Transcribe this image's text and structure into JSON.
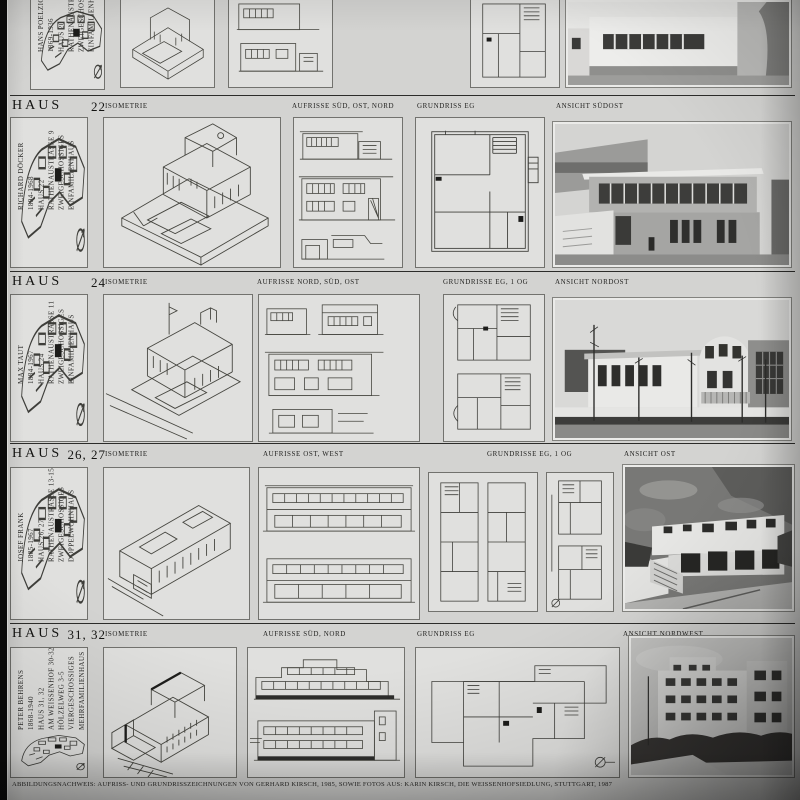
{
  "document": {
    "caption": "ABBILDUNGSNACHWEIS: AUFRISS- UND GRUNDRISSZEICHNUNGEN VON GERHARD KIRSCH, 1985, SOWIE FOTOS AUS: KARIN KIRSCH, DIE WEISSENHOFSIEDLUNG, STUTTGART, 1987",
    "top_partial_row": {
      "info": [
        "HANS POELZIG",
        "1869-1936",
        "HAUS 20",
        "RATHENAUSTRA",
        "ZWEIGESCHOSS",
        "EINFAMILIENHA"
      ],
      "zerstort": "ZERSTÖRT"
    },
    "rows": [
      {
        "header": {
          "haus": "HAUS",
          "number": "22",
          "cols": {
            "iso": "ISOMETRIE",
            "aufriss": "AUFRISSE SÜD, OST, NORD",
            "grundriss": "GRUNDRISS EG",
            "ansicht": "ANSICHT SÜDOST"
          }
        },
        "info": [
          "RICHARD DÖCKER",
          "1894-1968",
          "HAUS 22",
          "RATHENAUSTRASSE 9",
          "ZWEIGESCHOSSIGES",
          "EINFAMILIENHAUS"
        ],
        "zerstort": "ZERSTÖRT"
      },
      {
        "header": {
          "haus": "HAUS",
          "number": "24",
          "cols": {
            "iso": "ISOMETRIE",
            "aufriss": "AUFRISSE NORD, SÜD, OST",
            "grundriss": "GRUNDRISSE EG, 1 OG",
            "ansicht": "ANSICHT NORDOST"
          }
        },
        "info": [
          "MAX TAUT",
          "1884-1967",
          "HAUS 24",
          "RATHENAUSTRASSE 11",
          "ZWEIGESCHOSSIGES",
          "EINFAMILIENHAUS"
        ],
        "zerstort": "ZERSTÖRT"
      },
      {
        "header": {
          "haus": "HAUS",
          "number": "26, 27",
          "cols": {
            "iso": "ISOMETRIE",
            "aufriss": "AUFRISSE OST, WEST",
            "grundriss": "GRUNDRISSE EG, 1 OG",
            "ansicht": "ANSICHT OST"
          }
        },
        "info": [
          "JOSEF FRANK",
          "1885-1967",
          "HAUS 26, 27",
          "RATHENAUSTRASSE 13-15",
          "ZWEIGESCHOSSIGES",
          "DOPPELWOHNHAUS"
        ]
      },
      {
        "header": {
          "haus": "HAUS",
          "number": "31, 32",
          "cols": {
            "iso": "ISOMETRIE",
            "aufriss": "AUFRISSE SÜD, NORD",
            "grundriss": "GRUNDRISS EG",
            "ansicht": "ANSICHT NORDWEST"
          }
        },
        "info": [
          "PETER BEHRENS",
          "1868-1940",
          "HAUS 31, 32",
          "AM WEISSENHOF 30-32",
          "HÖLZELWEG 3-5",
          "VIERGESCHOSSIGES",
          "MEHRFAMILIENHAUS"
        ]
      }
    ]
  }
}
